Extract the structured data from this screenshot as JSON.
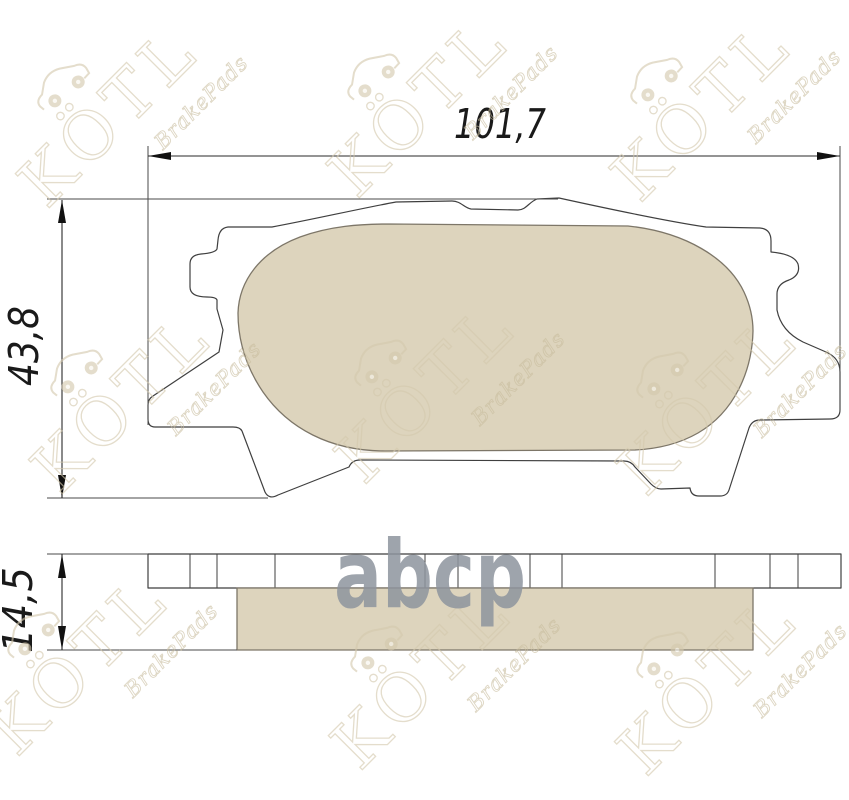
{
  "page": {
    "background": "#ffffff"
  },
  "drawing": {
    "title": "brake-pad technical drawing, plan view and edge view",
    "dimensions": {
      "width_mm": "101,7",
      "height_mm": "43,8",
      "thickness_mm": "14,5"
    }
  },
  "watermark": {
    "brand": "KÖTL",
    "brand_sub": "BrakePads",
    "brand_color": "#d4c9ad",
    "sub_color": "#c9bd9e",
    "center_logo": "abcp",
    "center_logo_color": "#8e949e"
  },
  "colors": {
    "friction_fill": "#ddd4bd",
    "friction_stroke": "#7d7668",
    "backplate_fill": "#ffffff",
    "outline": "#3f3f3f",
    "dimension_line": "#2a2a2a",
    "dimension_text": "#1a1a1a"
  }
}
